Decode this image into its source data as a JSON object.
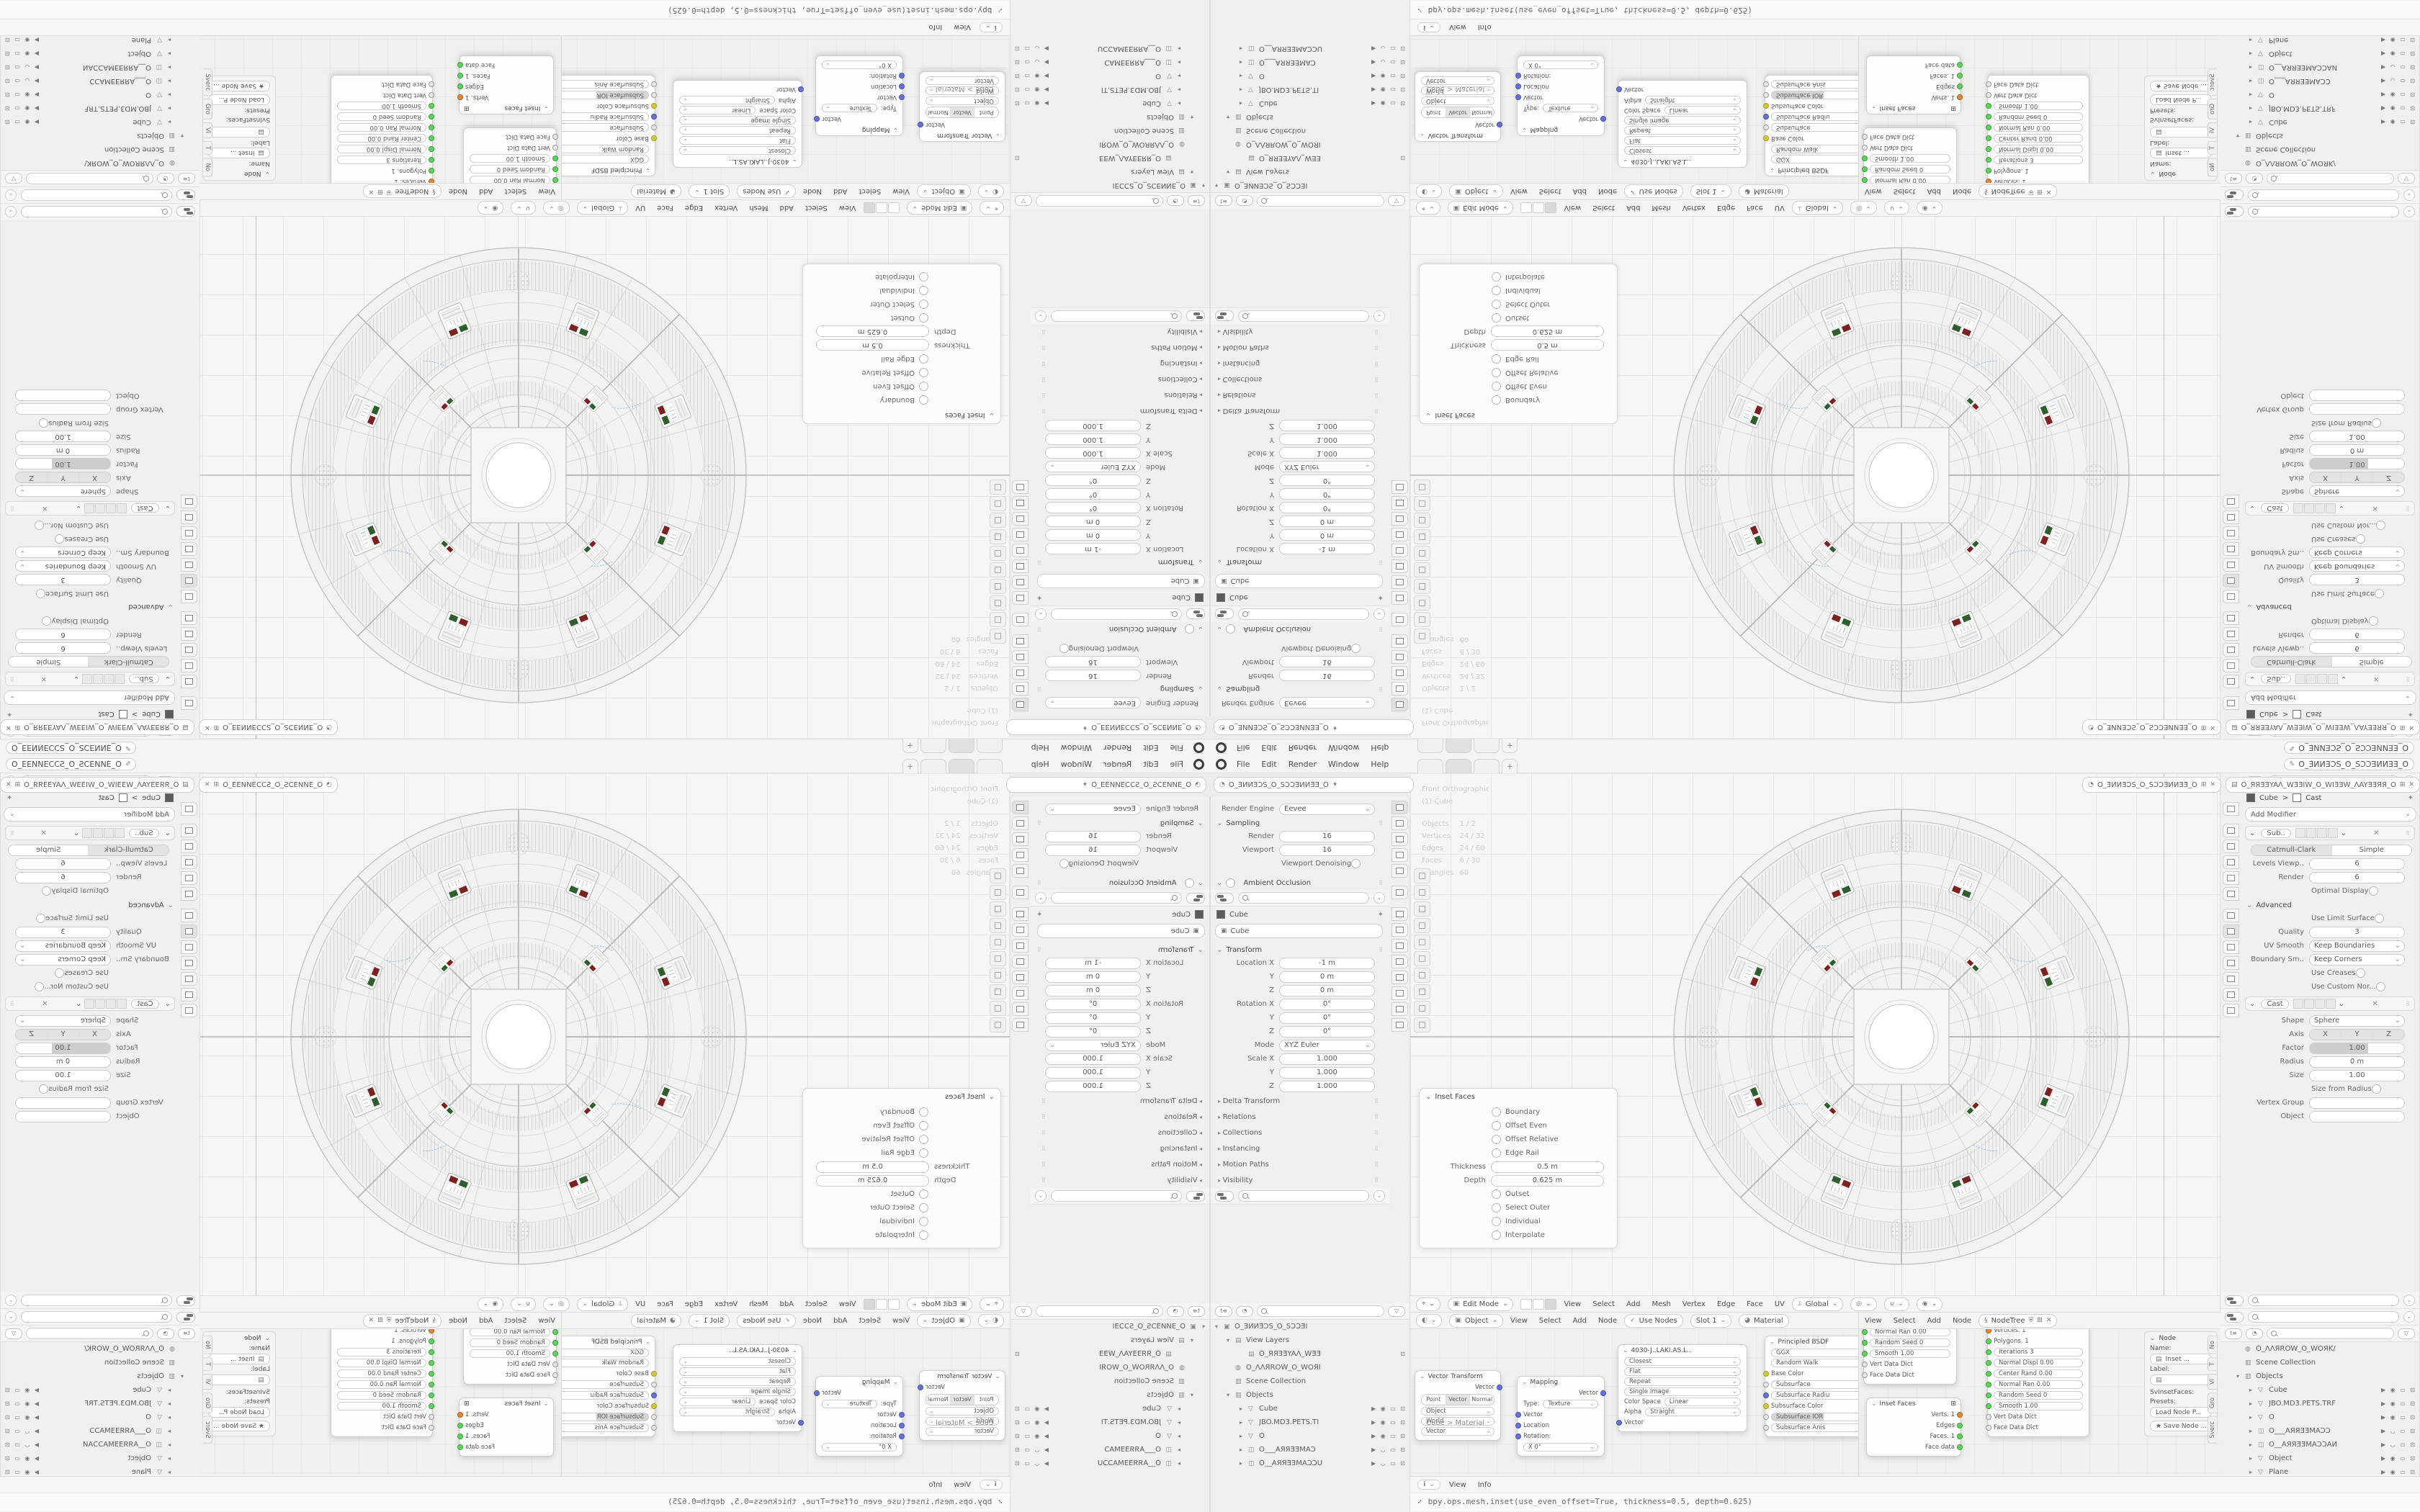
{
  "colors": {
    "socket_green": "#5fd35f",
    "socket_orange": "#e0883a",
    "socket_blue": "#6673d2",
    "socket_yellow": "#d2c63a",
    "selection_row": "#dcdcdc",
    "panel_bg": "#f0f0f0",
    "viewport_bg": "#f6f6f5"
  },
  "topbar": {
    "menus": [
      {
        "l": "File"
      },
      {
        "l": "Edit"
      },
      {
        "l": "Render"
      },
      {
        "l": "Window"
      },
      {
        "l": "Help"
      }
    ],
    "plus": "+",
    "scene_selector": "O_ƎИИƎƆS_O_SƆƆƎИИƎƎ_O",
    "viewlayer_selector": "O_ЯЯƎƎYAΛ_WƎƎIW_O_WIƎƎW_ΛAYƎƎЯЯ_O"
  },
  "props_header": {
    "breadcrumb": "O_ƎИИƎƆS_O_SƆƆƎИИƎƎ_O",
    "pin": "✦"
  },
  "render_props": {
    "engine_label": "Render Engine",
    "engine_value": "Eevee",
    "sampling_title": "Sampling",
    "rows": [
      {
        "t": "f",
        "l": "Render",
        "v": "16"
      },
      {
        "t": "f",
        "l": "Viewport",
        "v": "16"
      },
      {
        "t": "c",
        "l": "Viewport Denoising"
      }
    ],
    "ao_title": "Ambient Occlusion"
  },
  "object_props": {
    "breadcrumb": "Cube",
    "id_value": "Cube",
    "transform_title": "Transform",
    "rows": [
      {
        "t": "f",
        "l": "Location X",
        "v": "-1 m",
        "d": 1
      },
      {
        "t": "f",
        "l": "Y",
        "v": "0 m",
        "d": 1
      },
      {
        "t": "f",
        "l": "Z",
        "v": "0 m",
        "d": 1
      },
      {
        "t": "f",
        "l": "Rotation X",
        "v": "0°",
        "d": 1
      },
      {
        "t": "f",
        "l": "Y",
        "v": "0°",
        "d": 1
      },
      {
        "t": "f",
        "l": "Z",
        "v": "0°",
        "d": 1
      },
      {
        "t": "d",
        "l": "Mode",
        "v": "XYZ Euler",
        "d": 1
      },
      {
        "t": "f",
        "l": "Scale X",
        "v": "1.000",
        "d": 1
      },
      {
        "t": "f",
        "l": "Y",
        "v": "1.000",
        "d": 1
      },
      {
        "t": "f",
        "l": "Z",
        "v": "1.000",
        "d": 1
      }
    ],
    "collapsed": [
      {
        "l": "Delta Transform"
      },
      {
        "l": "Relations"
      },
      {
        "l": "Collections"
      },
      {
        "l": "Instancing"
      },
      {
        "l": "Motion Paths"
      },
      {
        "l": "Visibility"
      }
    ]
  },
  "outliner_left": {
    "rows": [
      {
        "ind": "0",
        "arr": "▾",
        "gl": "▣",
        "name": "O_ƎИИƎƆS_O_SƆƆƎI",
        "ics": "",
        "st": ""
      },
      {
        "ind": "1",
        "arr": "▾",
        "gl": "▤",
        "name": "View Layers",
        "ics": "",
        "st": ""
      },
      {
        "ind": "2",
        "arr": "",
        "gl": "▤",
        "name": "O_ЯЯƎƎYAΛ_WƎƎ",
        "ics": "⊡",
        "st": ""
      },
      {
        "ind": "1",
        "arr": "",
        "gl": "◍",
        "name": "O_ΛΛЯROW_O_WOЯI",
        "ics": "",
        "st": ""
      },
      {
        "ind": "1",
        "arr": "",
        "gl": "▥",
        "name": "Scene Collection",
        "ics": "",
        "st": ""
      },
      {
        "ind": "1",
        "arr": "▾",
        "gl": "▥",
        "name": "Objects",
        "ics": "",
        "st": ""
      },
      {
        "ind": "2",
        "arr": "▸",
        "gl": "▽",
        "name": "Cube",
        "ics": "▶ ◉ ▭ ⊡",
        "st": "hl"
      },
      {
        "ind": "2",
        "arr": "▸",
        "gl": "▽",
        "name": "JBO.MD3.PETS.TI",
        "ics": "▶ ◉ ▭ ⊡",
        "st": "dim"
      },
      {
        "ind": "2",
        "arr": "▸",
        "gl": "▽",
        "name": "O",
        "ics": "▶ ◉ ▭ ⊡",
        "st": "dim"
      },
      {
        "ind": "2",
        "arr": "▸",
        "gl": "◫",
        "name": "O___AЯЯƎƎMAƆ",
        "ics": "▶ ◡ ▭ ⊡",
        "st": "dim"
      },
      {
        "ind": "2",
        "arr": "▸",
        "gl": "◫",
        "name": "O__AЯЯƎƎMAƆƆU",
        "ics": "▶ ◡ ▭ ⊡",
        "st": "dim"
      }
    ]
  },
  "viewport": {
    "overlay": [
      {
        "l": "Front Orthographic"
      },
      {
        "l": "(1) Cube"
      }
    ],
    "stats": [
      {
        "k": "Objects",
        "v": "1 / 2"
      },
      {
        "k": "Vertices",
        "v": "24 / 32"
      },
      {
        "k": "Edges",
        "v": "24 / 60"
      },
      {
        "k": "Faces",
        "v": "6 / 30"
      },
      {
        "k": "Triangles",
        "v": "60"
      }
    ],
    "header": {
      "mode": "Edit Mode",
      "menus": [
        {
          "l": "View"
        },
        {
          "l": "Select"
        },
        {
          "l": "Add"
        },
        {
          "l": "Mesh"
        },
        {
          "l": "Vertex"
        },
        {
          "l": "Edge"
        },
        {
          "l": "Face"
        },
        {
          "l": "UV"
        }
      ],
      "orientation": "Global"
    },
    "inset": {
      "title": "Inset Faces",
      "toggles1": [
        {
          "t": "c",
          "l": "Boundary",
          "on": 0
        },
        {
          "t": "c",
          "l": "Offset Even",
          "on": 1
        },
        {
          "t": "c",
          "l": "Offset Relative",
          "on": 0
        },
        {
          "t": "c",
          "l": "Edge Rail",
          "on": 0
        }
      ],
      "fields": [
        {
          "t": "f",
          "l": "Thickness",
          "v": "0.5 m"
        },
        {
          "t": "f",
          "l": "Depth",
          "v": "0.625 m"
        }
      ],
      "toggles2": [
        {
          "t": "c",
          "l": "Outset",
          "on": 0
        },
        {
          "t": "c",
          "l": "Select Outer",
          "on": 0
        },
        {
          "t": "c",
          "l": "Individual",
          "on": 1
        },
        {
          "t": "c",
          "l": "Interpolate",
          "on": 1
        }
      ]
    }
  },
  "modifier_props": {
    "breadcrumb_obj": "Cube",
    "breadcrumb_sep": ">",
    "breadcrumb_mod": "Cast",
    "pin": "✦",
    "add_modifier": "Add Modifier",
    "subdiv": {
      "name": "Sub..",
      "seg": [
        "Catmull-Clark",
        "Simple"
      ],
      "rows1": [
        {
          "t": "f",
          "l": "Levels Viewp..",
          "v": "6",
          "d": 1
        },
        {
          "t": "f",
          "l": "Render",
          "v": "6",
          "d": 1
        },
        {
          "t": "c",
          "l": "Optimal Display",
          "d": 1
        }
      ],
      "advanced": "Advanced",
      "rows2": [
        {
          "t": "c",
          "l": "Use Limit Surface",
          "d": 1
        },
        {
          "t": "f",
          "l": "Quality",
          "v": "3",
          "st": "dim"
        },
        {
          "t": "d",
          "l": "UV Smooth",
          "v": "Keep Boundaries",
          "d": 1
        },
        {
          "t": "d",
          "l": "Boundary Sm..",
          "v": "Keep Corners",
          "d": 1
        },
        {
          "t": "c",
          "l": "Use Creases",
          "d": 1
        },
        {
          "t": "c",
          "l": "Use Custom Nor...",
          "d": 1
        }
      ]
    },
    "cast": {
      "name": "Cast",
      "axis_label": "Axis",
      "axis": [
        "X",
        "Y",
        "Z"
      ],
      "rows1": [
        {
          "t": "d",
          "l": "Shape",
          "v": "Sphere",
          "d": 1
        }
      ],
      "rows2": [
        {
          "t": "sl",
          "l": "Factor",
          "v": "1.00",
          "d": 1
        },
        {
          "t": "f",
          "l": "Radius",
          "v": "0 m",
          "d": 1
        },
        {
          "t": "f",
          "l": "Size",
          "v": "1.00",
          "d": 1
        },
        {
          "t": "c",
          "l": "Size from Radius",
          "d": 1
        },
        {
          "t": "f",
          "l": "Vertex Group",
          "v": ""
        },
        {
          "t": "f",
          "l": "Object",
          "v": ""
        }
      ]
    }
  },
  "outliner_right": {
    "rows": [
      {
        "ind": "1",
        "arr": "",
        "gl": "◍",
        "name": "O_ΛΛЯROW_O_WOЯK/",
        "ics": "",
        "st": ""
      },
      {
        "ind": "1",
        "arr": "",
        "gl": "▥",
        "name": "Scene Collection",
        "ics": "",
        "st": ""
      },
      {
        "ind": "1",
        "arr": "▾",
        "gl": "▥",
        "name": "Objects",
        "ics": "",
        "st": ""
      },
      {
        "ind": "2",
        "arr": "▸",
        "gl": "▽",
        "name": "Cube",
        "ics": "▶ ◉ ▭ ⊡",
        "st": "hl"
      },
      {
        "ind": "2",
        "arr": "▸",
        "gl": "▽",
        "name": "JBO.MD3.PETS.TRF",
        "ics": "▶ ◉ ▭ ⊡",
        "st": "dim"
      },
      {
        "ind": "2",
        "arr": "▸",
        "gl": "▽",
        "name": "O",
        "ics": "▶ ◉ ▭ ⊡",
        "st": "dim"
      },
      {
        "ind": "2",
        "arr": "▸",
        "gl": "◫",
        "name": "O___AЯЯƎƎMAƆƆ",
        "ics": "▶ ◡ ▭ ⊡",
        "st": "dim"
      },
      {
        "ind": "2",
        "arr": "▸",
        "gl": "◫",
        "name": "O__AЯЯƎƎMAƆƆAИ",
        "ics": "▶ ◡ ▭ ⊡",
        "st": "dim"
      },
      {
        "ind": "2",
        "arr": "▸",
        "gl": "▽",
        "name": "Object",
        "ics": "▶ ◉ ▭ ⊡",
        "st": "dim"
      },
      {
        "ind": "2",
        "arr": "▸",
        "gl": "▽",
        "name": "Plane",
        "ics": "▶ ◉ ▭ ⊡",
        "st": "dim"
      },
      {
        "ind": "2",
        "arr": "▸",
        "gl": "▽",
        "name": "SBINEL",
        "ics": "▶ ◉ ▭ ⊡",
        "st": "dim"
      }
    ]
  },
  "shader": {
    "header": {
      "id": "Object",
      "menus": [
        {
          "l": "View"
        },
        {
          "l": "Select"
        },
        {
          "l": "Add"
        },
        {
          "l": "Node"
        }
      ],
      "use_nodes": "Use Nodes",
      "slot": "Slot 1",
      "mat": "Material"
    },
    "breadcrumb": "Cube  >  Material",
    "vt": {
      "title": "Vector Transform",
      "out": "Vector",
      "seg": [
        "Point",
        "Vector",
        "Normal"
      ],
      "drops": [
        {
          "v": "Object"
        },
        {
          "v": "World"
        },
        {
          "v": "Vector"
        }
      ]
    },
    "mapping": {
      "title": "Mapping",
      "out": "Vector",
      "type_label": "Type:",
      "type_value": "Texture",
      "ins": [
        {
          "c": "b",
          "t": "Vector"
        },
        {
          "c": "b",
          "t": "Location"
        },
        {
          "c": "b",
          "t": "Rotation:"
        }
      ],
      "x_field": "X          0°"
    },
    "tex": {
      "title": "4030-J..LAKI.AS.L..",
      "drops": [
        {
          "v": "Closest"
        },
        {
          "v": "Flat"
        },
        {
          "v": "Repeat"
        },
        {
          "v": "Single Image"
        }
      ],
      "cs_label": "Color Space",
      "cs_value": "Linear",
      "a_label": "Alpha",
      "a_value": "Straight",
      "in_sock": "Vector"
    },
    "bsdf": {
      "title": "Principled BSDF",
      "drops": [
        {
          "v": "GGX"
        },
        {
          "v": "Random Walk"
        }
      ],
      "socks": [
        {
          "c": "y",
          "t": "Base Color",
          "p": "0"
        },
        {
          "c": "w",
          "t": "Subsurface",
          "p": "1"
        },
        {
          "c": "b",
          "t": "Subsurface Radiu",
          "p": "1"
        },
        {
          "c": "y",
          "t": "Subsurface Color",
          "p": "0"
        },
        {
          "c": "w",
          "t": "Subsurface IOR",
          "p": "2"
        },
        {
          "c": "w",
          "t": "Subsurface Anis",
          "p": "1"
        }
      ]
    }
  },
  "sverchok": {
    "menus": [
      {
        "l": "View"
      },
      {
        "l": "Select"
      },
      {
        "l": "Add"
      },
      {
        "l": "Node"
      }
    ],
    "tree": "NodeTree",
    "nodeA": {
      "rows": [
        {
          "c": "g",
          "t": "Normal Ran   0.00",
          "p": "1"
        },
        {
          "c": "g",
          "t": "Random Seed   0",
          "p": "1"
        },
        {
          "c": "g",
          "t": "Smooth   1.00",
          "p": "1"
        },
        {
          "c": "w",
          "t": "Vert Data Dict",
          "p": "0"
        },
        {
          "c": "w",
          "t": "Face Data Dict",
          "p": "0"
        }
      ]
    },
    "nodeB": {
      "title": "Inset Faces",
      "grid": "⊞",
      "outs": [
        {
          "c": "o",
          "t": "Verts. 1"
        },
        {
          "c": "g",
          "t": "Edges"
        },
        {
          "c": "g",
          "t": "Faces. 1"
        },
        {
          "c": "g",
          "t": "Face data"
        }
      ]
    },
    "nodeC": {
      "outs": [
        {
          "c": "o",
          "t": "Vertices. 1"
        },
        {
          "c": "g",
          "t": "Polygons. 1"
        }
      ],
      "rows": [
        {
          "c": "g",
          "t": "Iterations   3",
          "p": "1"
        },
        {
          "c": "g",
          "t": "Normal Displ  0.00",
          "p": "1"
        },
        {
          "c": "g",
          "t": "Center Rand  0.00",
          "p": "1"
        },
        {
          "c": "g",
          "t": "Normal Ran   0.00",
          "p": "1"
        },
        {
          "c": "g",
          "t": "Random Seed   0",
          "p": "1"
        },
        {
          "c": "g",
          "t": "Smooth   1.00",
          "p": "1"
        },
        {
          "c": "w",
          "t": "Vert Data Dict",
          "p": "0"
        },
        {
          "c": "w",
          "t": "Face Data Dict",
          "p": "0"
        }
      ]
    },
    "npanel": {
      "title": "Node",
      "name_label": "Name:",
      "name_value": "Inset ...",
      "label_label": "Label:",
      "label_value": "",
      "id_value": "SvInsetFaces:",
      "presets": "Presets:",
      "load": "Load Node P...",
      "save": "★ Save Node ...",
      "tabs": [
        {
          "l": "No"
        },
        {
          "l": "T"
        },
        {
          "l": "Vi"
        },
        {
          "l": "Gro"
        },
        {
          "l": "Sverc"
        }
      ]
    }
  },
  "info": {
    "menus": [
      {
        "l": "View"
      },
      {
        "l": "Info"
      }
    ],
    "check": "✓",
    "log": "bpy.ops.mesh.inset(use_even_offset=True, thickness=0.5, depth=0.625)"
  }
}
